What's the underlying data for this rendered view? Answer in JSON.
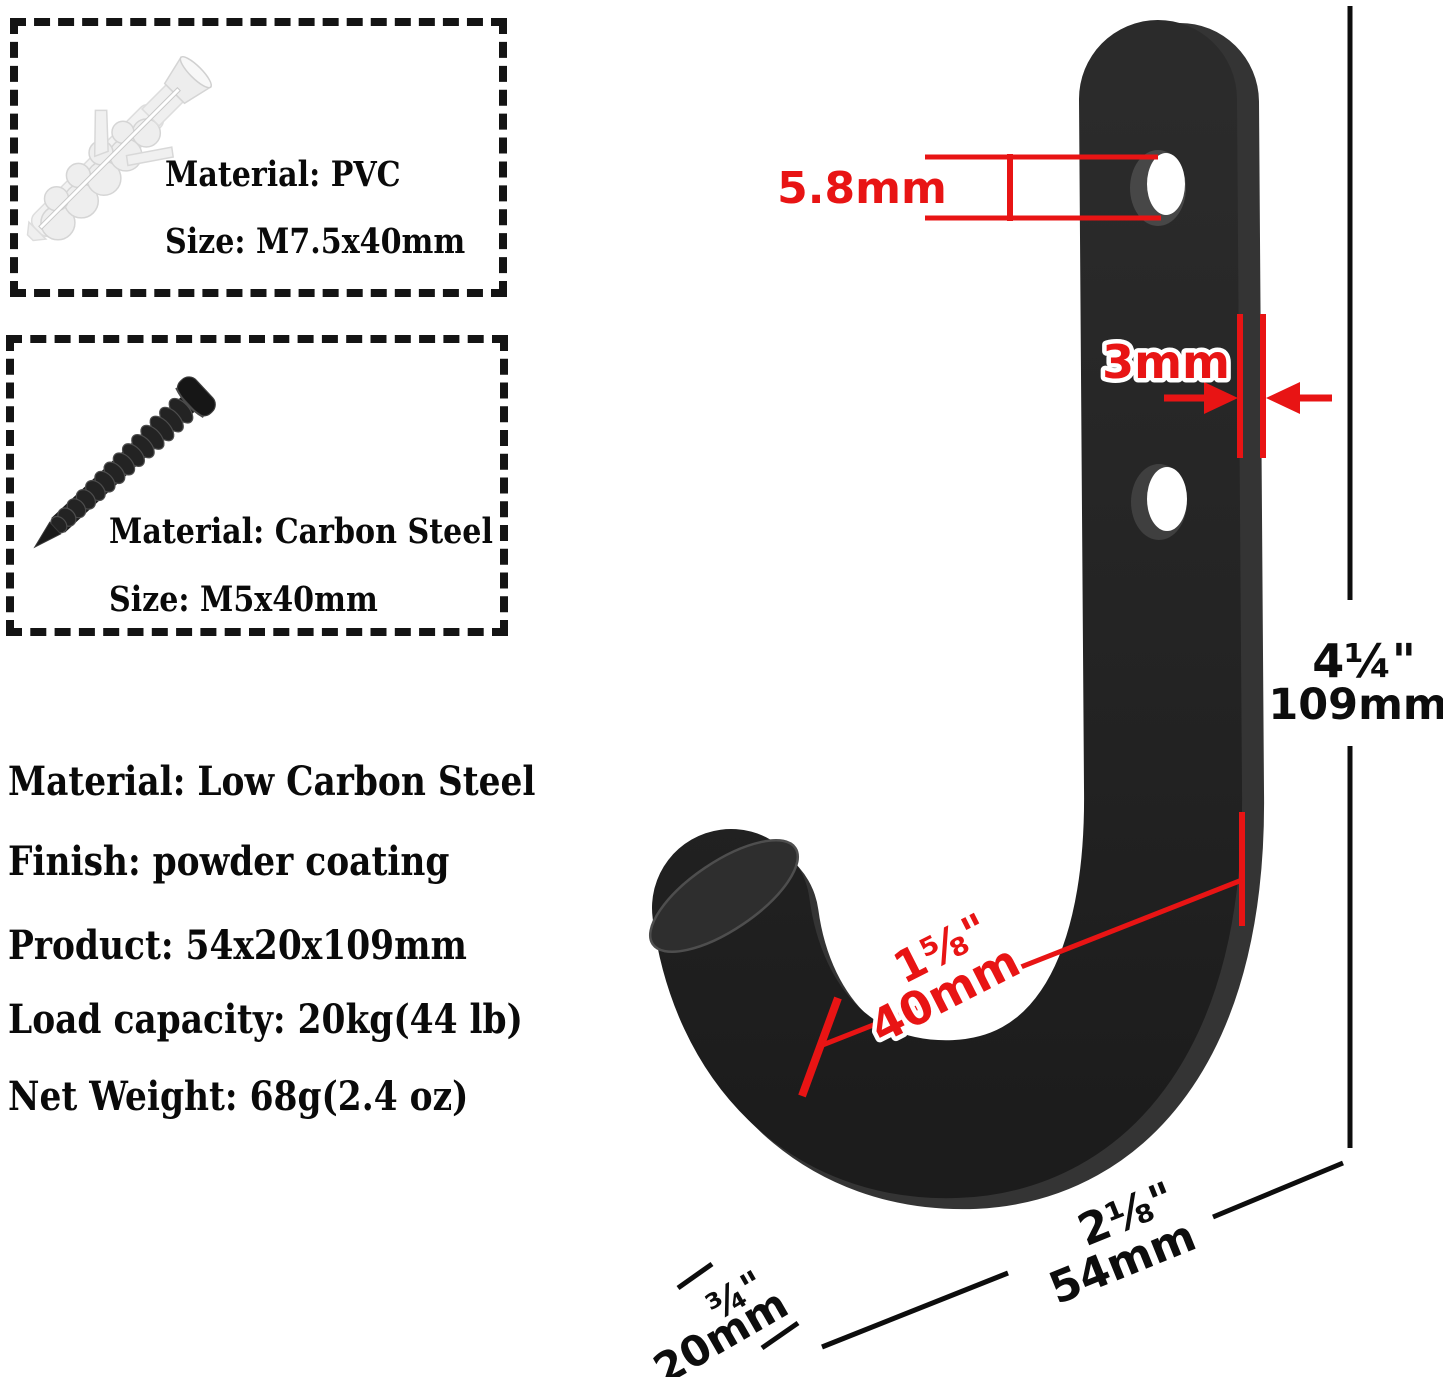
{
  "colors": {
    "annotation_red": "#e81414",
    "annotation_black": "#0d0d0d",
    "hook_color": "#232323",
    "background": "#ffffff"
  },
  "anchor_box": {
    "material_label": "Material: PVC",
    "size_label": "Size: M7.5x40mm"
  },
  "screw_box": {
    "material_label": "Material: Carbon Steel",
    "size_label": "Size: M5x40mm"
  },
  "specs": {
    "lines": [
      "Material: Low Carbon Steel",
      "Finish: powder coating",
      "Product: 54x20x109mm",
      "Load capacity: 20kg(44 lb)",
      "Net Weight: 68g(2.4 oz)"
    ]
  },
  "dimensions": {
    "hole_diameter": "5.8mm",
    "plate_thickness": "3mm",
    "height_inches": "4¼\"",
    "height_mm": "109mm",
    "hook_opening_inches": "1⅝\"",
    "hook_opening_mm": "40mm",
    "width_inches": "2⅛\"",
    "width_mm": "54mm",
    "depth_inches": "¾\"",
    "depth_mm": "20mm"
  },
  "icons": {
    "wall_anchor": "wall-anchor-photo",
    "screw": "screw-photo",
    "hook": "j-hook-photo"
  }
}
